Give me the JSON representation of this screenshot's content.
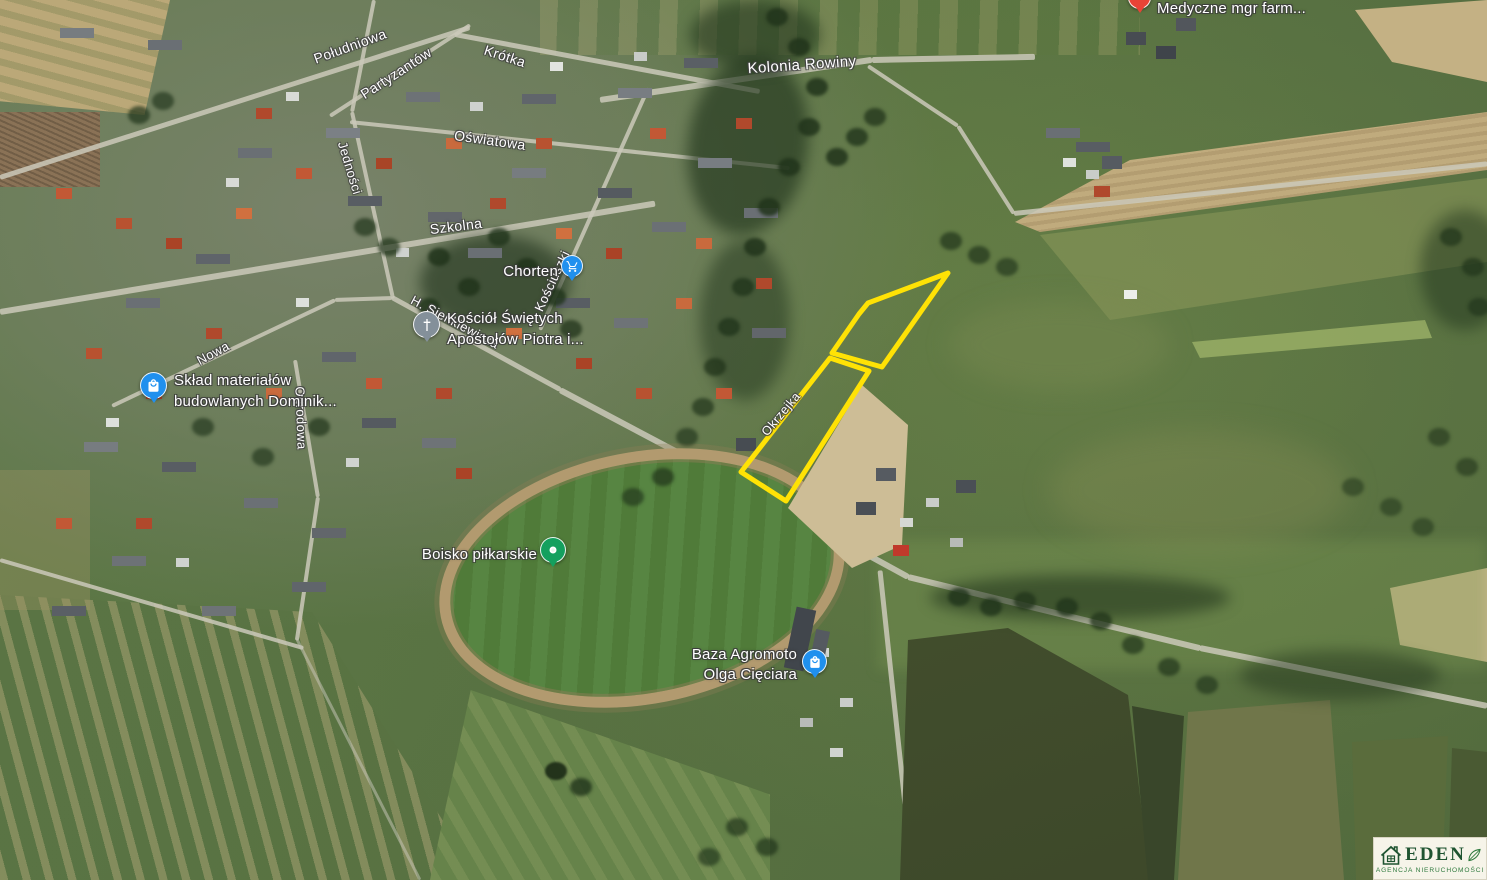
{
  "map": {
    "streets": {
      "poludniowa": "Południowa",
      "partyzantow": "Partyzantów",
      "krotka": "Krótka",
      "jednosci": "Jedności",
      "oswiatowa": "Oświatowa",
      "szkolna": "Szkolna",
      "kolonia_rowiny": "Kolonia Rowiny",
      "h_sienkiewicza": "H. Sienkiewicza",
      "kosciuszki": "Kościuszki",
      "nowa": "Nowa",
      "ogrodowa": "Ogrodowa",
      "okrzejka": "Okrzejka"
    },
    "pois": {
      "chorten": {
        "label": "Chorten",
        "pin": "shopping-cart-blue"
      },
      "church": {
        "line1": "Kościół Świętych",
        "line2": "Apostołów Piotra i...",
        "pin": "church-gray"
      },
      "building_materials": {
        "line1": "Skład materiałów",
        "line2": "budowlanych Dominik...",
        "pin": "shopping-bag-blue"
      },
      "football_pitch": {
        "label": "Boisko piłkarskie",
        "pin": "park-green"
      },
      "agromoto": {
        "line1": "Baza Agromoto",
        "line2": "Olga Cięciara",
        "pin": "shopping-bag-blue"
      },
      "medical": {
        "label": "Medyczne mgr farm...",
        "pin": "health-red"
      }
    },
    "colors": {
      "parcel_outline": "#ffe205",
      "pin_blue": "#2090ee",
      "pin_green": "#14a05e",
      "pin_gray": "#84909a",
      "pin_red": "#e84336"
    }
  },
  "logo": {
    "brand": "EDEN",
    "subtitle": "AGENCJA NIERUCHOMOŚCI"
  }
}
